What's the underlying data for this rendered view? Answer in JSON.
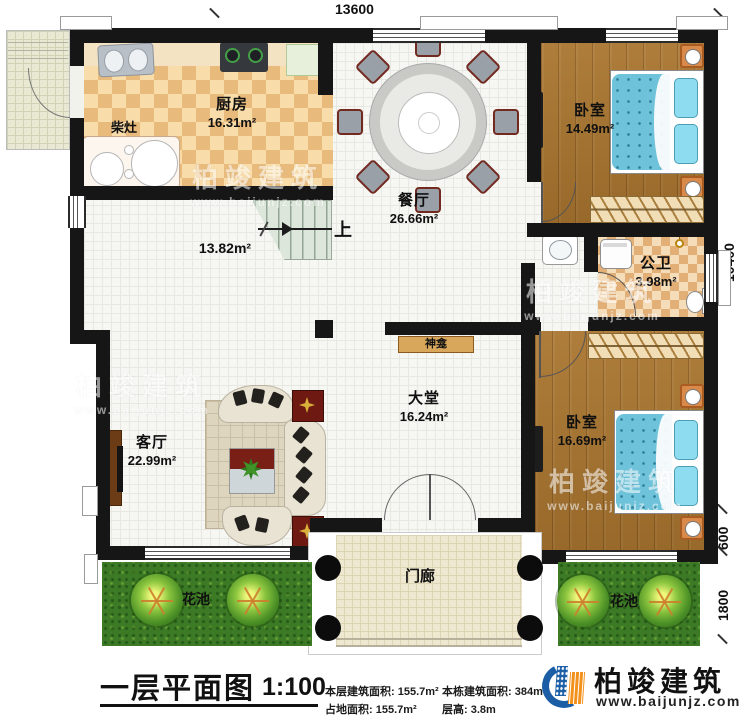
{
  "dimensions": {
    "top_width": "13600",
    "right_main": "10400",
    "right_step": "600",
    "right_flowerbed": "1800"
  },
  "rooms": {
    "kitchen": {
      "name": "厨房",
      "area": "16.31m²"
    },
    "wood_stove": {
      "name": "柴灶"
    },
    "stair_hall": {
      "area": "13.82m²",
      "up_label": "上"
    },
    "dining": {
      "name": "餐厅",
      "area": "26.66m²"
    },
    "bedroom_top": {
      "name": "卧室",
      "area": "14.49m²"
    },
    "bathroom": {
      "name": "公卫",
      "area": "3.98m²"
    },
    "shrine": {
      "name": "神龛"
    },
    "hall": {
      "name": "大堂",
      "area": "16.24m²"
    },
    "living": {
      "name": "客厅",
      "area": "22.99m²"
    },
    "bedroom_bottom": {
      "name": "卧室",
      "area": "16.69m²"
    },
    "porch": {
      "name": "门廊"
    },
    "flowerbed_left": {
      "name": "花池"
    },
    "flowerbed_right": {
      "name": "花池"
    }
  },
  "watermark": {
    "brand": "柏竣建筑",
    "url": "www.baijunjz.com"
  },
  "footer": {
    "title": "一层平面图",
    "scale": "1:100",
    "stats": [
      {
        "label": "本层建筑面积:",
        "value": "155.7m²"
      },
      {
        "label": "占地面积:",
        "value": "155.7m²"
      },
      {
        "label": "本栋建筑面积:",
        "value": "384m²"
      },
      {
        "label": "层高:",
        "value": "3.8m"
      }
    ],
    "logo": {
      "brand": "柏竣建筑",
      "url": "www.baijunjz.com"
    }
  },
  "colors": {
    "wall": "#161616",
    "accent_blue": "#1b5ea6",
    "accent_orange": "#f2921d",
    "grass": "#3c7a26"
  }
}
